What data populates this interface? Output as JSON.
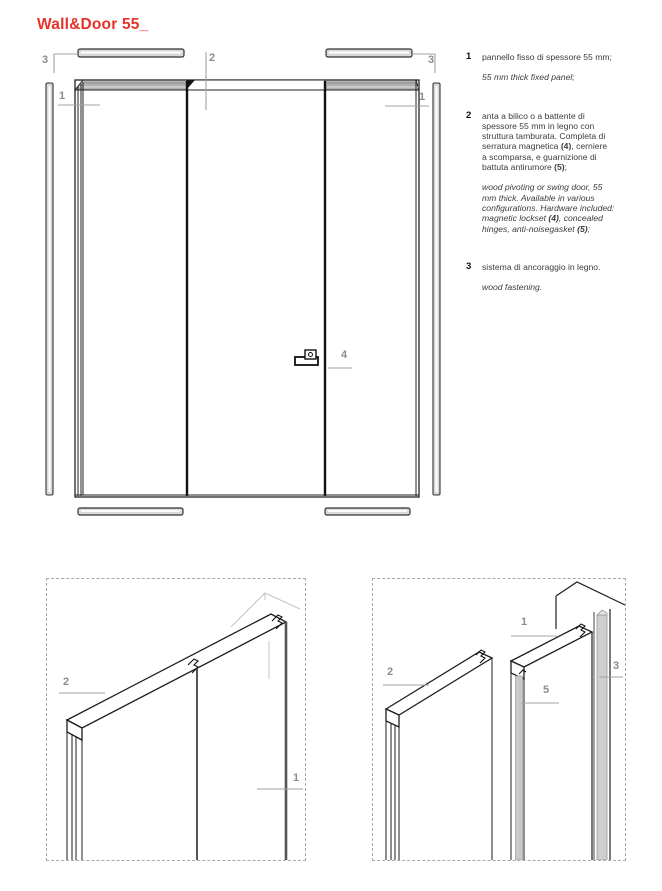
{
  "page": {
    "title": "Wall&Door 55_",
    "accent_color": "#e5332a",
    "callout_color": "#8c8c8c",
    "leader_line_color": "#a3a3a3"
  },
  "legend": {
    "items": [
      {
        "num": "1",
        "it": "pannello fisso di spessore 55 mm;",
        "en": "55 mm thick fixed panel;"
      },
      {
        "num": "2",
        "it_s1": "anta a bilico o a battente di\nspessore 55 mm in legno con\nstruttura tamburata. Completa di\nserratura magnetica ",
        "it_b1": "(4)",
        "it_s2": ", cerniere\na scomparsa, e guarnizione di\nbattuta antirumore ",
        "it_b2": "(5)",
        "it_s3": ";",
        "en_s1": "wood pivoting or swing door, 55\nmm thick. Available in various\nconfigurations. Hardware included:\nmagnetic lockset ",
        "en_b1": "(4)",
        "en_s2": ", concealed\nhinges, anti-noisegasket ",
        "en_b2": "(5)",
        "en_s3": ";"
      },
      {
        "num": "3",
        "it": "sistema di ancoraggio in legno.",
        "en": "wood fastening."
      }
    ]
  },
  "drawing": {
    "callouts": {
      "c3_left": "3",
      "c2_top": "2",
      "c3_right": "3",
      "c1_left": "1",
      "c1_right": "1",
      "c4": "4"
    }
  },
  "detail_left": {
    "callouts": {
      "c2": "2",
      "c1": "1"
    }
  },
  "detail_right": {
    "callouts": {
      "c1": "1",
      "c2": "2",
      "c5": "5",
      "c3": "3"
    }
  }
}
